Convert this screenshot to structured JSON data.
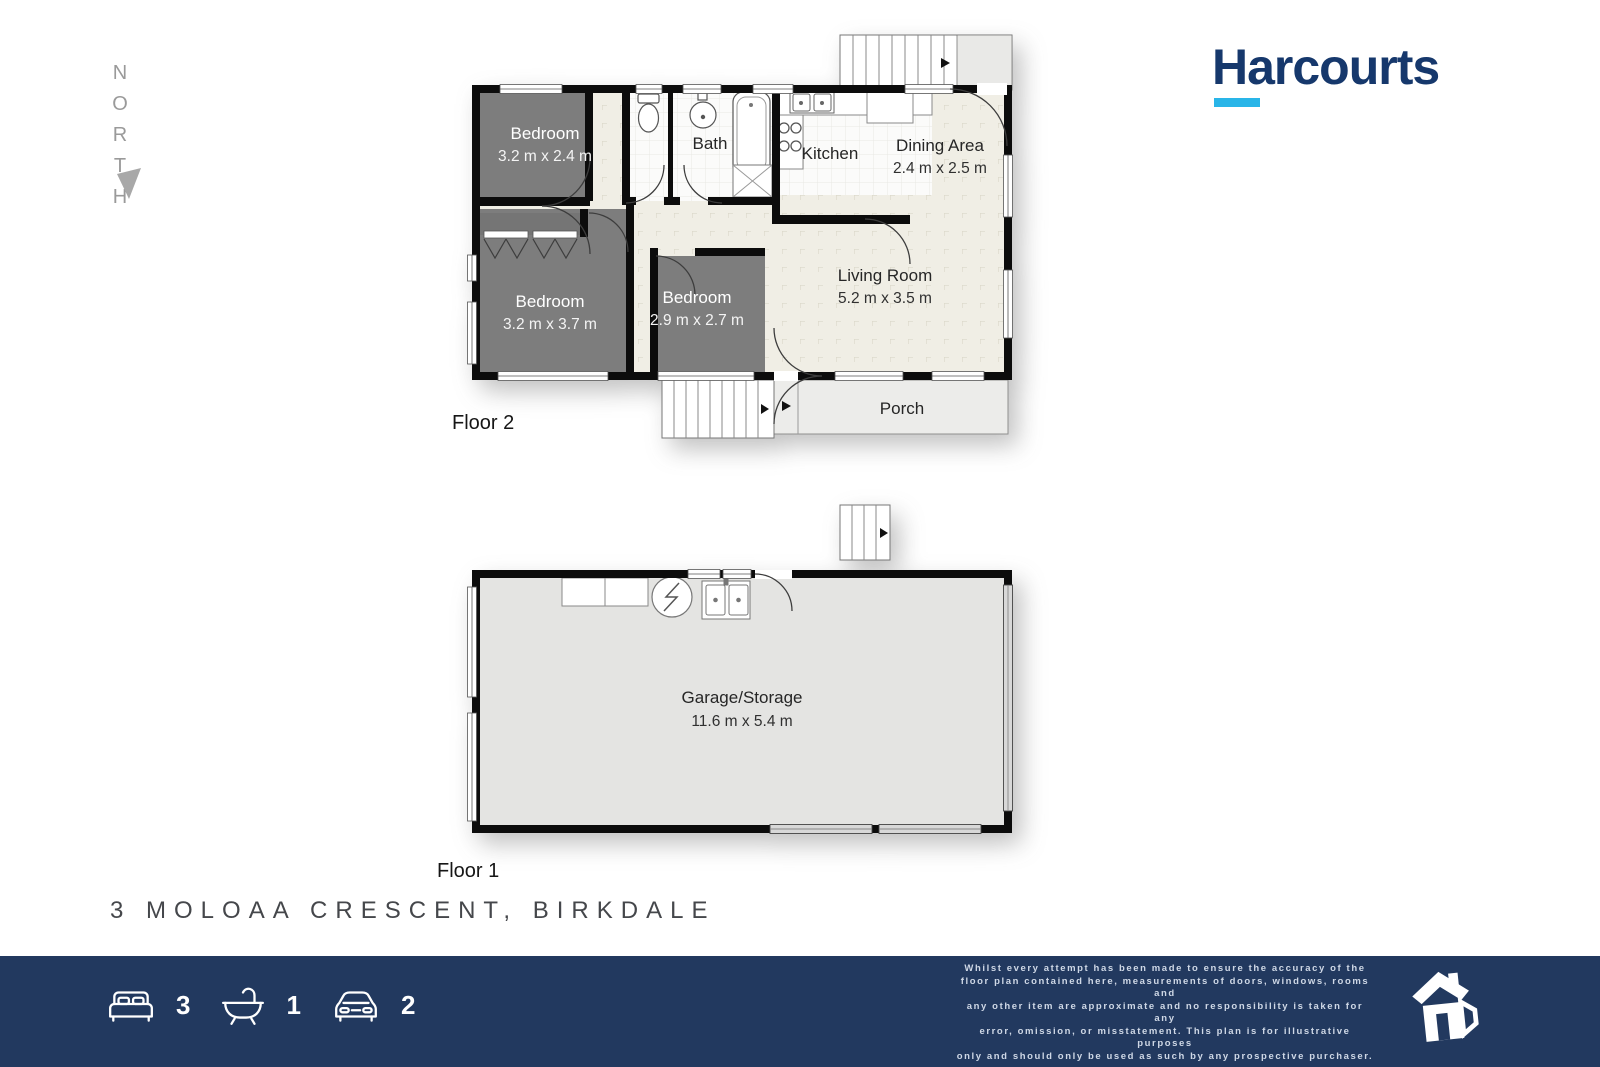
{
  "north": {
    "label": "NORTH"
  },
  "brand": {
    "name": "Harcourts",
    "navy": "#16386c",
    "cyan": "#29b5e8"
  },
  "floor2": {
    "label": "Floor 2",
    "bedroom_tl": {
      "name": "Bedroom",
      "dims": "3.2 m x 2.4 m"
    },
    "bath": {
      "name": "Bath"
    },
    "kitchen": {
      "name": "Kitchen"
    },
    "dining": {
      "name": "Dining Area",
      "dims": "2.4 m x 2.5 m"
    },
    "living": {
      "name": "Living Room",
      "dims": "5.2 m x 3.5 m"
    },
    "bedroom_bl": {
      "name": "Bedroom",
      "dims": "3.2 m x 3.7 m"
    },
    "bedroom_bm": {
      "name": "Bedroom",
      "dims": "2.9 m x 2.7 m"
    },
    "porch": {
      "name": "Porch"
    }
  },
  "floor1": {
    "label": "Floor 1",
    "garage": {
      "name": "Garage/Storage",
      "dims": "11.6 m x 5.4 m"
    }
  },
  "address": "3 MOLOAA CRESCENT, BIRKDALE",
  "footer": {
    "beds": "3",
    "baths": "1",
    "cars": "2",
    "disclaimer": [
      "Whilst every attempt has been made to ensure the accuracy of the",
      "floor plan contained here, measurements of doors, windows, rooms and",
      "any other item are approximate and no responsibility is taken for any",
      "error, omission, or misstatement. This plan is for illustrative purposes",
      "only and should only be used as such by any prospective purchaser."
    ]
  },
  "colors": {
    "wall": "#0c0c0c",
    "bedroom_fill": "#7d7d7d",
    "floor_beige": "#f0eee5",
    "tile_white": "#fbfbfa",
    "porch_gray": "#ececea",
    "garage_gray": "#e4e4e2",
    "footer_navy": "#22395f"
  }
}
